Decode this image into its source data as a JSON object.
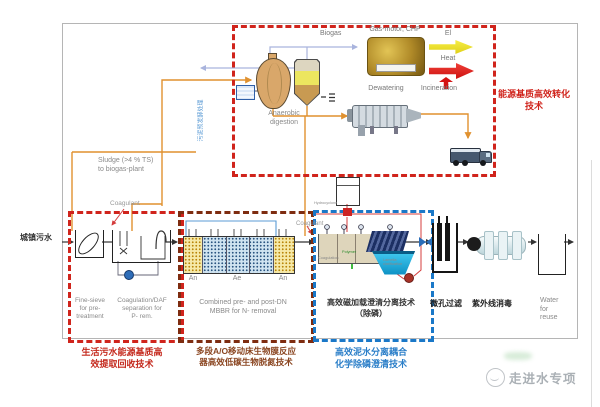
{
  "influent": {
    "label": "城镇污水"
  },
  "sludge": {
    "to_biogas_label": "Sludge (>4 % TS)\nto biogas-plant",
    "pretreat_note": "污泥预发酵处理"
  },
  "energy": {
    "tech_label": "能源基质高效转化\n技术",
    "biogas_label": "Biogas",
    "gas_motor_label": "Gas-motor, CHP",
    "el_label": "El",
    "heat_label": "Heat",
    "dewatering_label": "Dewatering",
    "incineration_label": "Incineration",
    "anaerobic_label": "Anaerobic\ndigestion"
  },
  "pretreat": {
    "coagulant_label": "Coagulant",
    "fine_sieve_label": "Fine-sieve\nfor pre-\ntreatment",
    "daf_label": "Coagulation/DAF\nseparation for\nP- rem.",
    "tech_label": "生活污水能源基质高\n效提取回收技术"
  },
  "mbbr": {
    "zones": [
      "An",
      "Ae",
      "An"
    ],
    "caption": "Combined pre- and post-DN\nMBBR for N- removal",
    "tech_label": "多段A/O移动床生物膜反应\n器高效低碳生物脱氮技术"
  },
  "clarifier": {
    "coagulant_label": "Coagulant",
    "hydrocyclone_label": "Hydrocyclone",
    "coagulation_label": "Coagulation",
    "polymer_label": "Polymer",
    "lamella_label": "Lamella\nclarification",
    "caption": "高效磁加载澄清分离技术\n（除磷）",
    "tech_label": "高效泥水分离耦合\n化学除磷澄清技术"
  },
  "polish": {
    "microfilter_label": "微孔过滤",
    "uv_label": "紫外线消毒",
    "reuse_label": "Water\nfor\nreuse"
  },
  "watermark": {
    "text": "走进水专项"
  }
}
